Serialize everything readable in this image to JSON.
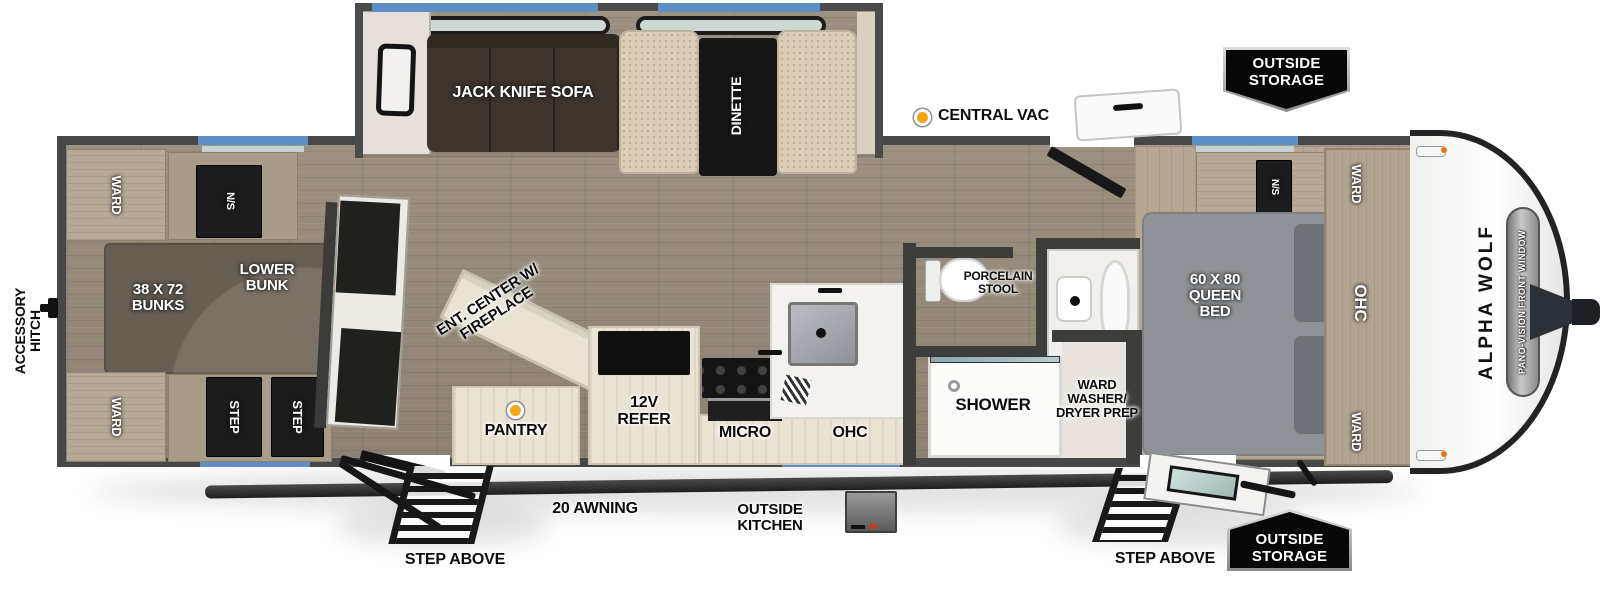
{
  "plan": {
    "brand": "ALPHA WOLF",
    "front_window": "PANO-VISION FRONT WINDOW",
    "accessory_hitch": "ACCESSORY HITCH"
  },
  "callouts": {
    "central_vac": "CENTRAL VAC",
    "outside_storage_top": "OUTSIDE STORAGE",
    "outside_storage_bottom": "OUTSIDE STORAGE",
    "step_above_left": "STEP ABOVE",
    "step_above_right": "STEP ABOVE",
    "awning": "20 AWNING",
    "outside_kitchen": "OUTSIDE KITCHEN"
  },
  "slideout": {
    "sofa": "JACK KNIFE SOFA",
    "dinette": "DINETTE"
  },
  "bunk_room": {
    "ward_top": "WARD",
    "ward_bottom": "WARD",
    "nightstand": "N/S",
    "bunks": "38 X 72 BUNKS",
    "lower_bunk": "LOWER BUNK",
    "step_front": "STEP",
    "step_rear": "STEP"
  },
  "living_kitchen": {
    "ent_center": "ENT. CENTER W/ FIREPLACE",
    "pantry": "PANTRY",
    "refrigerator": "12V REFER",
    "microwave": "MICRO",
    "overhead_cabinet": "OHC"
  },
  "bathroom": {
    "toilet": "PORCELAIN STOOL",
    "shower": "SHOWER",
    "washer_prep": "WARD WASHER/ DRYER PREP"
  },
  "bedroom": {
    "bed": "60 X 80 QUEEN BED",
    "nightstand_top": "N/S",
    "nightstand_bottom": "N/S",
    "ward_top": "WARD",
    "ward_bottom": "WARD",
    "overhead_cabinet": "OHC"
  },
  "colors": {
    "window_blue": "#5d8fc4",
    "wall_gray": "#474747",
    "marker_orange": "#f2a71b",
    "floor_wood": "#95897b",
    "cabinet_wood": "#b4a791",
    "cream_cabinet": "#eae3d3",
    "sofa_brown": "#3d352d",
    "bed_gray": "#8f9397",
    "badge_black": "#070707"
  }
}
